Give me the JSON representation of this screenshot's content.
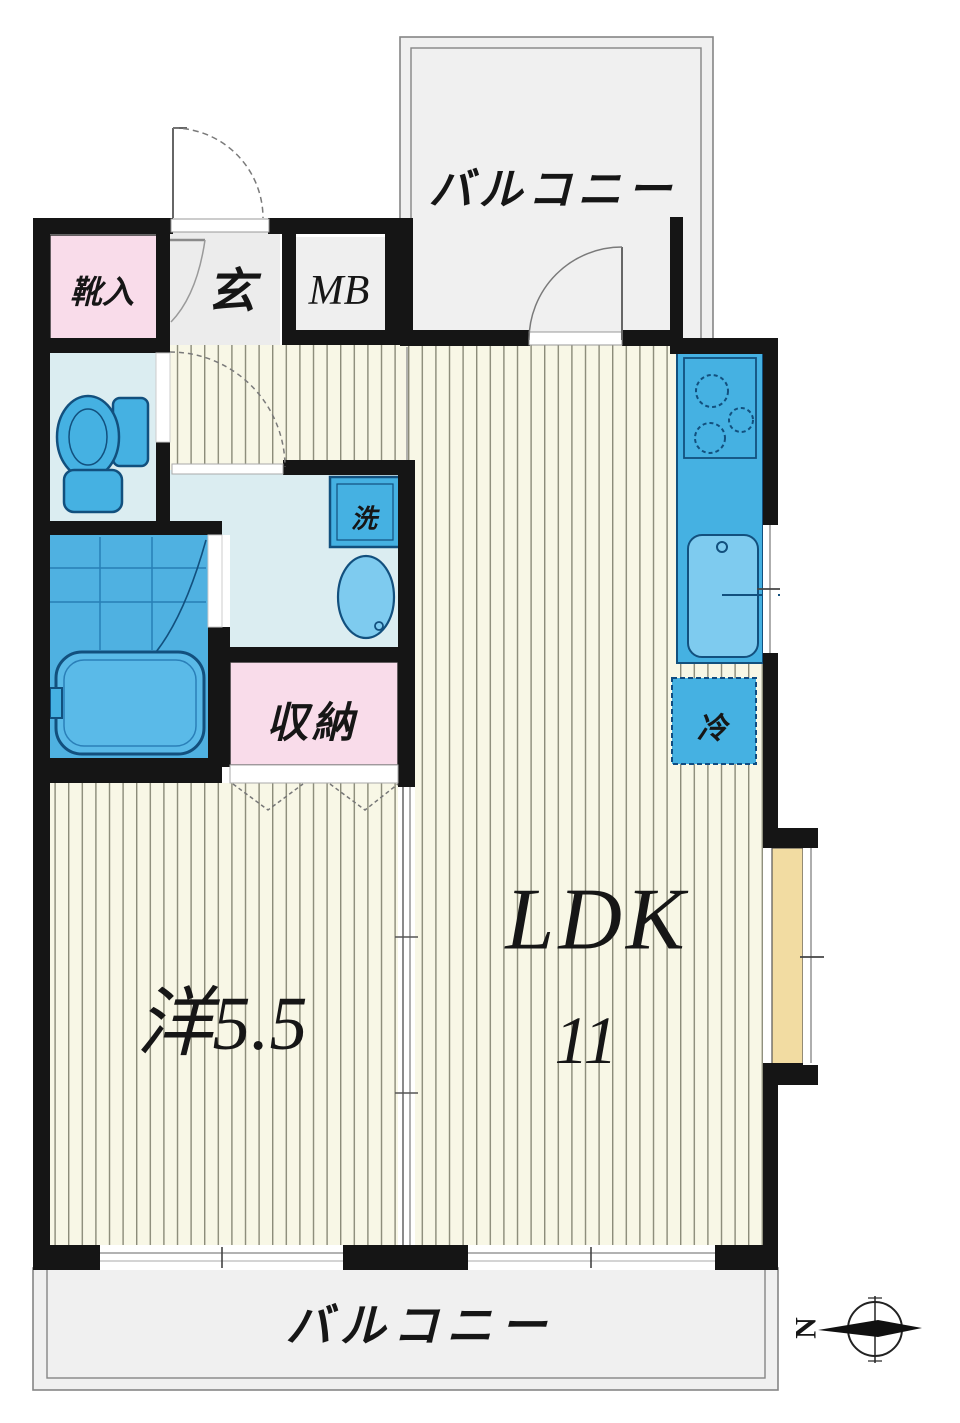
{
  "floorplan": {
    "rooms": {
      "balcony_top": "バルコニー",
      "balcony_bottom": "バルコニー",
      "shoe_cabinet": "靴入",
      "entrance": "玄",
      "meter_box": "MB",
      "washer": "洗",
      "storage": "収納",
      "refrigerator": "冷",
      "western_room": "洋5.5",
      "ldk_label": "LDK",
      "ldk_size": "11"
    },
    "compass": {
      "north_label": "N"
    },
    "colors": {
      "wall": "#151515",
      "floor_cream": "#f8f7e6",
      "stripe": "#8b8b79",
      "balcony_gray": "#f0f0f0",
      "room_pink": "#f9dcea",
      "room_cyan": "#dbedf1",
      "bath_blue": "#4fb1e1",
      "fixture_blue": "#45b1e2",
      "fixture_light": "#7ecbef",
      "fixture_stroke": "#12507e",
      "bay_tan": "#f2dca2",
      "label_ink": "#161616"
    }
  }
}
